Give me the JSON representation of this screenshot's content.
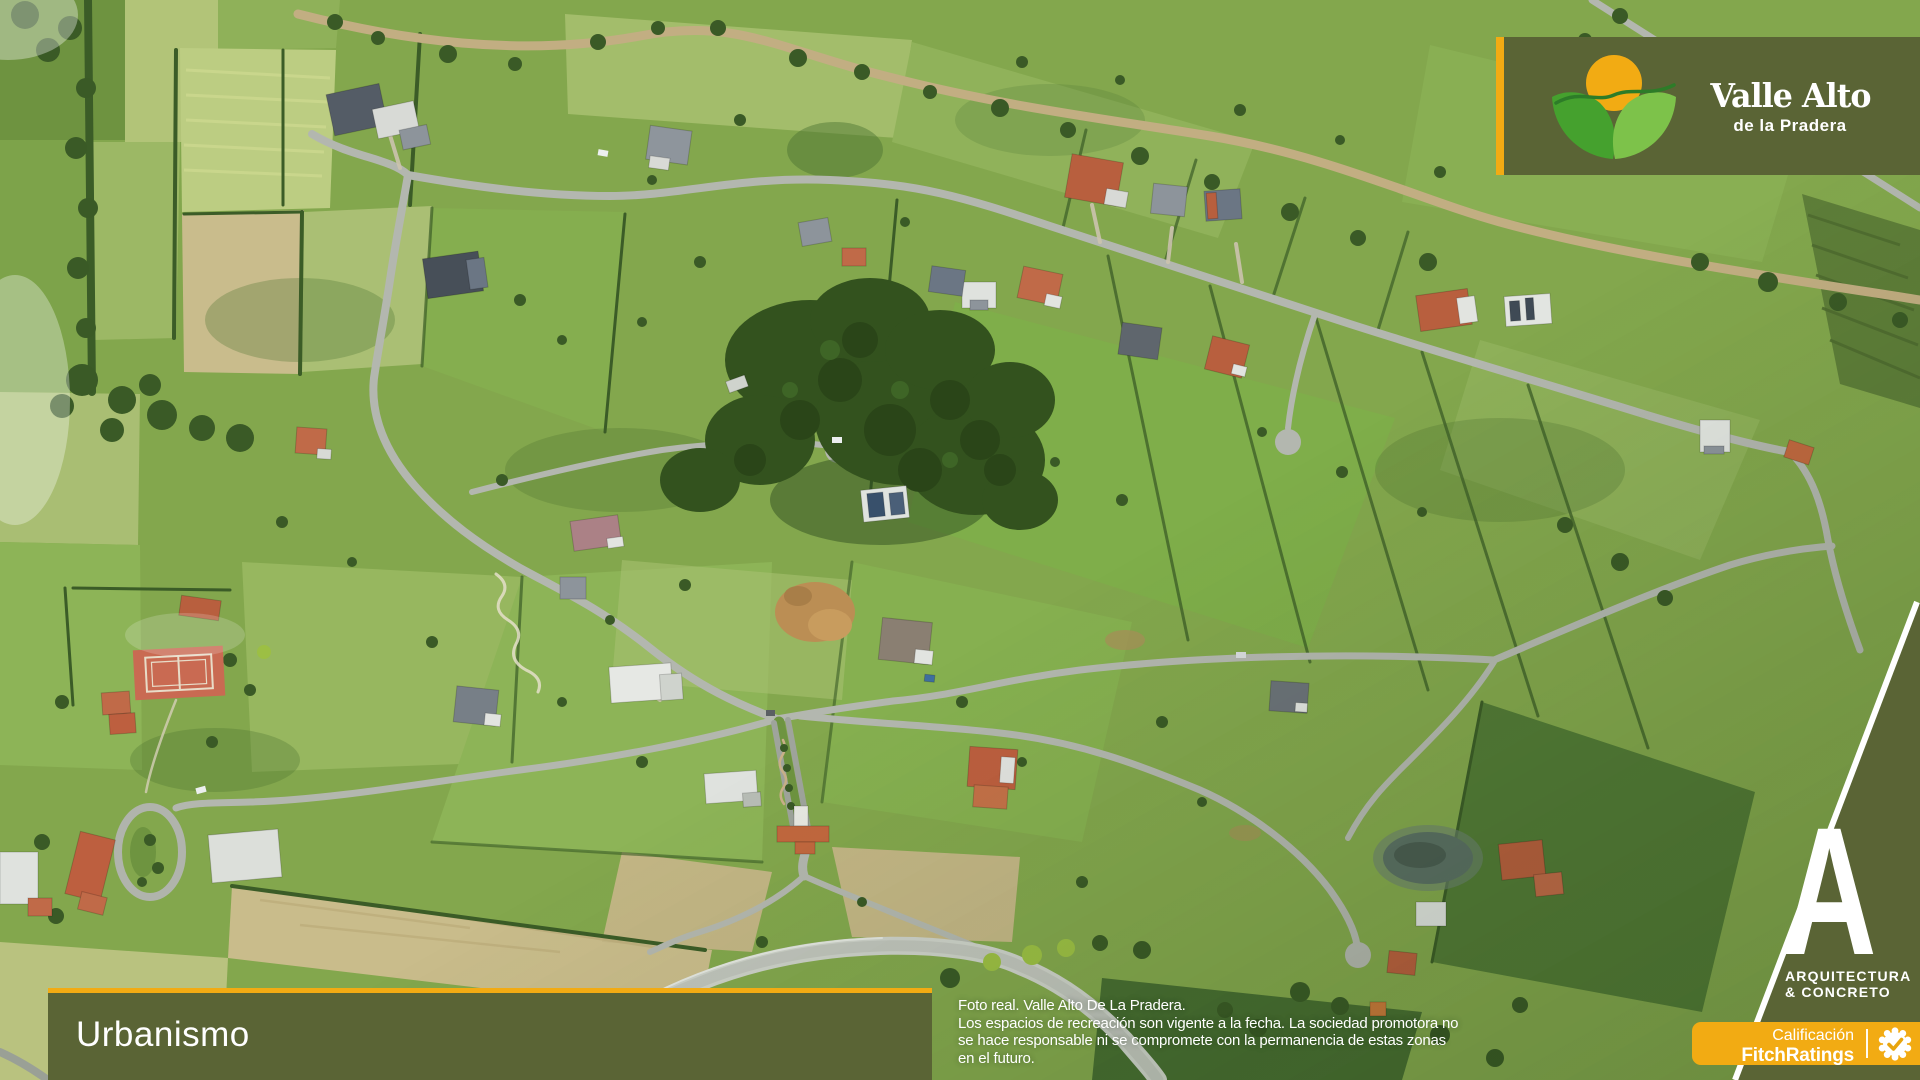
{
  "theme": {
    "olive": "#5a6435",
    "gold": "#f2ab13",
    "text_light": "#ffffff"
  },
  "brand": {
    "logo_icon": "sun-over-hills-icon",
    "name": "Valle Alto",
    "subtitle": "de la Pradera"
  },
  "footer": {
    "section_label": "Urbanismo"
  },
  "disclaimer": {
    "lines": [
      "Foto real. Valle Alto De La Pradera.",
      "Los espacios de recreación son vigente a la fecha. La sociedad promotora no",
      "se hace responsable ni se compromete con la permanencia de estas zonas",
      "en el futuro."
    ]
  },
  "partner": {
    "monogram": "A",
    "line1": "ARQUITECTURA",
    "line2": "& CONCRETO"
  },
  "rating": {
    "label": "Calificación",
    "agency": "FitchRatings",
    "badge_icon": "seal-check-icon"
  }
}
